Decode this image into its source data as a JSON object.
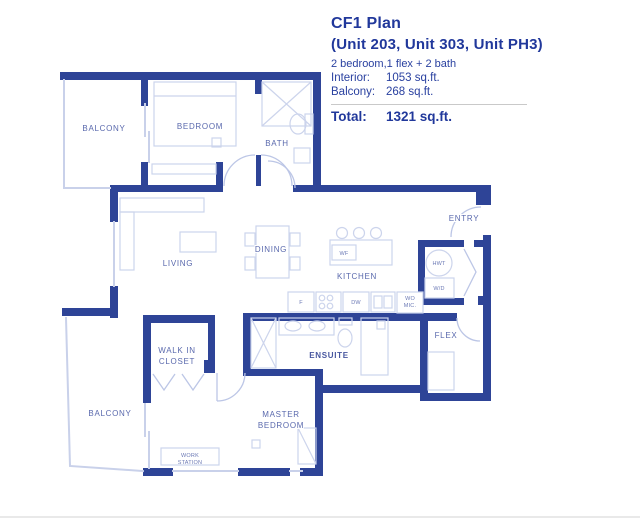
{
  "title_block": {
    "plan_name": "CF1 Plan",
    "units": "(Unit 203,  Unit 303,  Unit PH3)",
    "configuration": "2 bedroom,1 flex + 2 bath",
    "interior_label": "Interior:",
    "interior_value": "1053 sq.ft.",
    "balcony_label": "Balcony:",
    "balcony_value": "268 sq.ft.",
    "total_label": "Total:",
    "total_value": "1321 sq.ft."
  },
  "rooms": {
    "balcony_top": "BALCONY",
    "bedroom": "BEDROOM",
    "bath": "BATH",
    "living": "LIVING",
    "dining": "DINING",
    "kitchen": "KITCHEN",
    "entry": "ENTRY",
    "flex": "FLEX",
    "walk_in_1": "WALK IN",
    "walk_in_2": "CLOSET",
    "ensuite": "ENSUITE",
    "master_1": "MASTER",
    "master_2": "BEDROOM",
    "work_1": "WORK",
    "work_2": "STATION",
    "balcony_bottom": "BALCONY"
  },
  "fixtures": {
    "hwt": "HWT",
    "wd": "W/D",
    "wf": "WF",
    "fridge": "F",
    "dishwasher": "DW",
    "wo": "WO",
    "mic": "MIC."
  },
  "colors": {
    "wall": "#2e4497",
    "accent_text": "#21389b",
    "room_label": "#5a69ad",
    "light_line": "#c9d1ea"
  }
}
